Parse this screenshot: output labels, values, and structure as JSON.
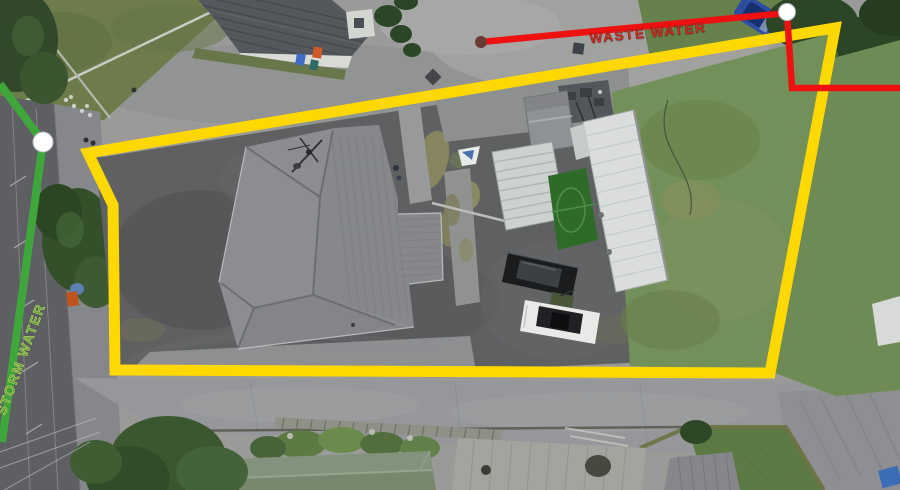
{
  "annotations": {
    "marker_fill": "#FFFFFF",
    "marker_stroke": "#B9BEC2",
    "boundary": {
      "color": "#FFD800",
      "stroke_width": 11,
      "points": "88,153 835,28 770,373 115,370 113,205"
    },
    "waste_water": {
      "label": "WASTE WATER",
      "label_color": "#D03428",
      "line_color": "#EE1111",
      "stroke_width": 6.5,
      "points": "481,42 787,13 792,88 902,88",
      "start_dot": {
        "cx": 481,
        "cy": 42,
        "r": 6,
        "fill": "#6B3A34"
      },
      "junction": {
        "cx": 787,
        "cy": 12,
        "r": 8.5
      }
    },
    "storm_water": {
      "label": "STORM WATER",
      "label_color": "#5A9C3E",
      "line_color": "#3FA63C",
      "stroke_width": 8,
      "points": "0,84 43,142 2,442",
      "junction": {
        "cx": 43,
        "cy": 142,
        "r": 10
      }
    }
  }
}
